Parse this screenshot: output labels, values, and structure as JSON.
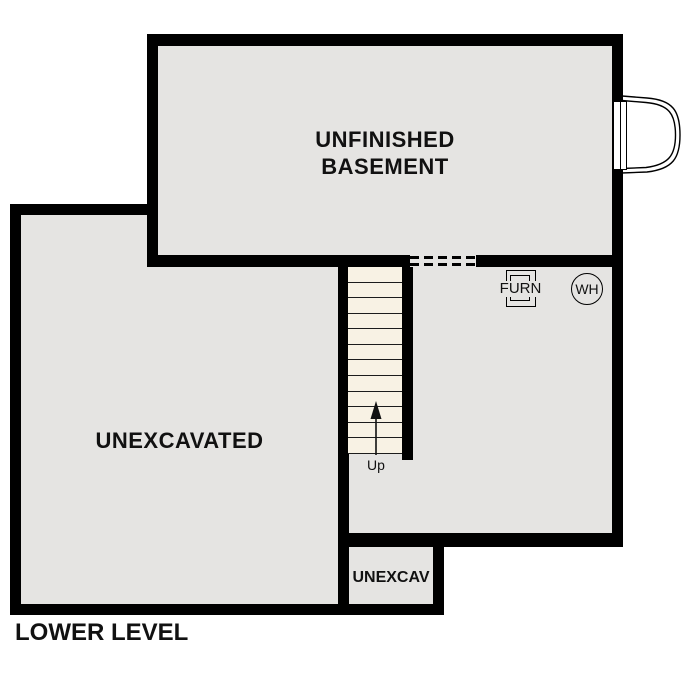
{
  "plan": {
    "title": "LOWER LEVEL",
    "rooms": [
      {
        "id": "unfinished-basement",
        "label_line1": "UNFINISHED",
        "label_line2": "BASEMENT"
      },
      {
        "id": "unexcavated",
        "label": "UNEXCAVATED"
      },
      {
        "id": "unexcav-small",
        "label": "UNEXCAV"
      }
    ],
    "stairs": {
      "label": "Up",
      "direction": "up",
      "tread_count": 12
    },
    "fixtures": {
      "furnace_label": "FURN",
      "water_heater_label": "WH"
    },
    "features": {
      "bay_window": "egress-bay-window",
      "dashed_opening": "wall-opening-dashed"
    },
    "colors": {
      "floor": "#e5e4e2",
      "wall": "#000000",
      "stair_tread": "#f8f2e4",
      "background": "#ffffff",
      "text": "#111111"
    }
  }
}
